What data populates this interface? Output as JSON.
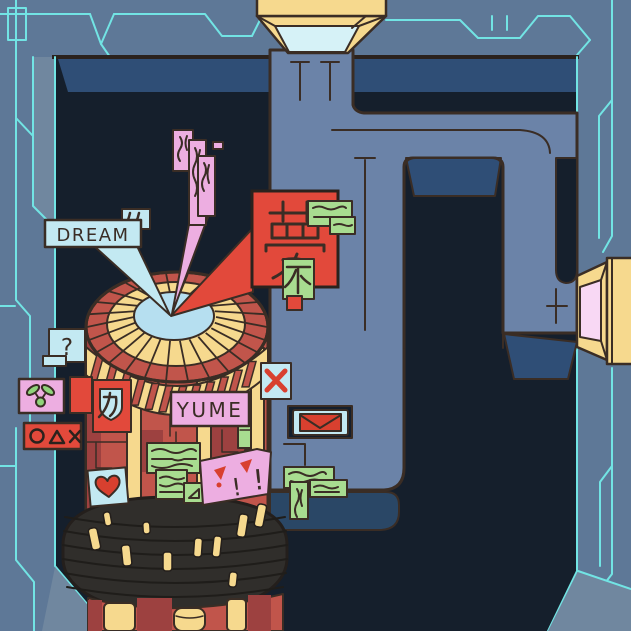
{
  "labels": {
    "dream": "DREAM",
    "yume": "YUME",
    "kanji_dream": "夢",
    "kanji_not": "不",
    "kanji_power": "力",
    "question_mark": "?",
    "quote_marks": "''",
    "exclamation": "!",
    "x_mark": "✕",
    "shape_symbols": "○ △ ✕",
    "envelope_symbol": "✉",
    "heart_symbol": "♥"
  },
  "icons": {
    "envelope": "envelope-icon",
    "heart": "heart-icon",
    "x_mark": "x-mark-icon",
    "sprout": "sprout-icon",
    "circle_triangle_cross": "circle-triangle-cross-icon",
    "triangle_ruler": "triangle-ruler-icon",
    "quote_marks": "quote-marks-icon",
    "scribbles": "illegible-scribble-text"
  },
  "colors": {
    "wall": "#5e7897",
    "wall_light": "#70879f",
    "crack": "#72e4e4",
    "recess": "#151f2c",
    "bevel": "#2f4e76",
    "bevel_dark": "#2a4766",
    "pipe": "#6b83a8",
    "outline": "#3a2d25",
    "cream": "#f6d98e",
    "funnel_inner": "#d6f2f7",
    "vent_inner": "#f8d8f4",
    "tower_red": "#c1554b",
    "tower_red_dark": "#9d4140",
    "sign_red": "#e2493b",
    "accent_red": "#d8402f",
    "green": "#a8dc90",
    "green_bright": "#8fd47a",
    "pink": "#edaee1",
    "pale_blue": "#c3e9f2",
    "inner_blue": "#b6dff0",
    "black_stack": "#302e2b"
  }
}
